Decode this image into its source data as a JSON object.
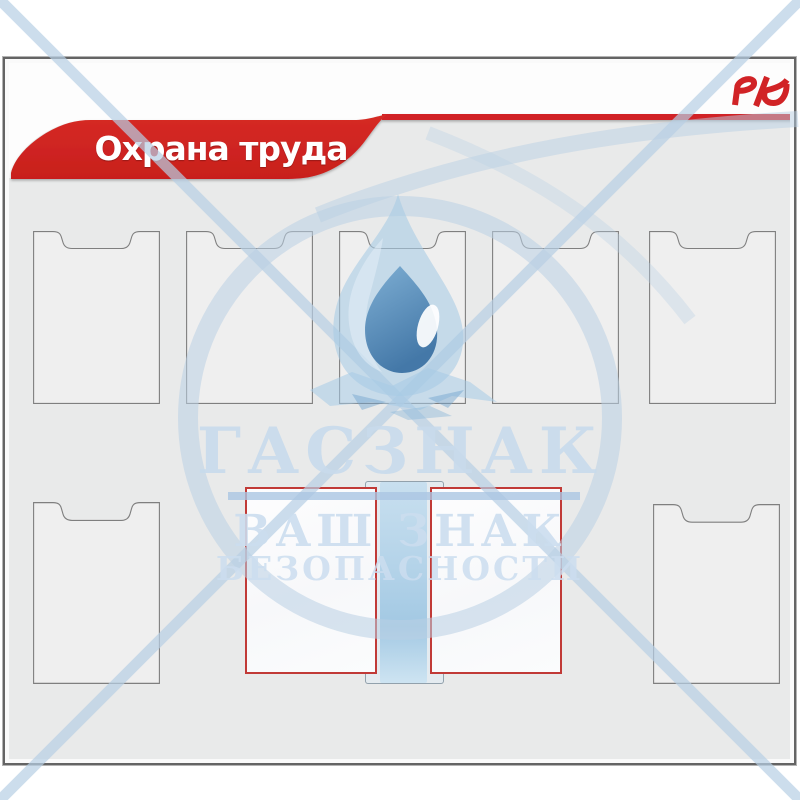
{
  "board": {
    "title": "Охрана труда",
    "brand": "РЖД"
  },
  "watermark": {
    "brand": "ГАСЗНАК",
    "tagline_line1": "ВАШ ЗНАК",
    "tagline_line2": "БЕЗОПАСНОСТИ"
  },
  "colors": {
    "accent_red": "#d12326",
    "panel_frame_red": "#c13a37",
    "board_gray": "#e9eaea",
    "watermark_blue": "#c3d6e8"
  },
  "layout_counts": {
    "top_row_pockets": 5,
    "bottom_flat_pockets": 2,
    "flip_panels": 2
  }
}
